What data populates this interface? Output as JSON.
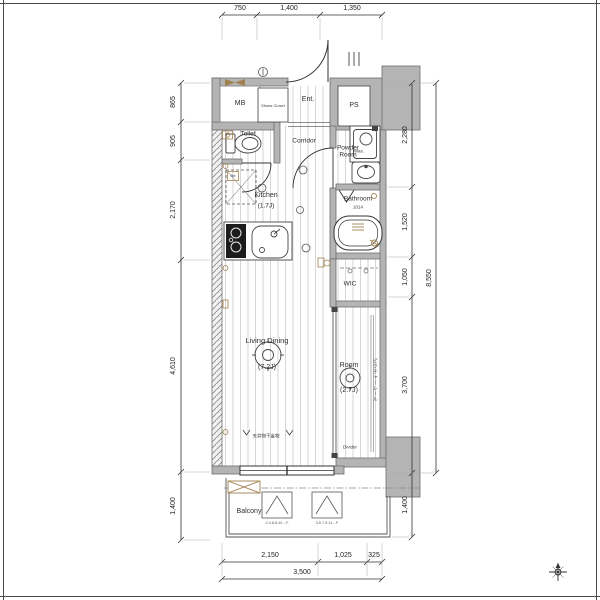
{
  "colors": {
    "wall_fill": "#b4b4b4",
    "wall_stroke": "#6f6f6f",
    "line": "#3c3c3c",
    "floor_stripe": "#d6d6d6",
    "accent_brown": "#a0824f",
    "text": "#2e2e2e"
  },
  "rooms": {
    "mb": {
      "label": "MB"
    },
    "shoes_closet": {
      "label": "Shoes Closet"
    },
    "entrance": {
      "label": "Ent."
    },
    "ps": {
      "label": "PS"
    },
    "toilet": {
      "label": "Toilet"
    },
    "corridor": {
      "label": "Corridor"
    },
    "powder_room": {
      "label": "Powder Room"
    },
    "washer": {
      "label": "Was."
    },
    "kitchen": {
      "label": "Kitchen",
      "size": "(1.7J)"
    },
    "bathroom": {
      "label": "Bathroom",
      "size": "1014"
    },
    "wic": {
      "label": "WIC"
    },
    "living_dining": {
      "label": "Living Dining",
      "size": "(7.2J)"
    },
    "room": {
      "label": "Room",
      "size": "(2.7J)"
    },
    "balcony": {
      "label": "Balcony"
    }
  },
  "annotations": {
    "divider": "Divider",
    "picture_rail": "ピクチャーレール",
    "ceiling_laundry_hanger": "天井物干金物",
    "refrigerator": "Re",
    "escape_hatch_floors_even": "2.4.6.8.10…F",
    "escape_hatch_floors_odd": "3.5.7.9.11…F"
  },
  "dimensions": {
    "top": [
      "750",
      "1,400",
      "1,350"
    ],
    "bottom": [
      "2,150",
      "1,025",
      "325"
    ],
    "bottom_total": "3,500",
    "left": [
      "865",
      "905",
      "2,170",
      "4,610",
      "1,400"
    ],
    "right": [
      "2,280",
      "1,520",
      "1,050",
      "3,700",
      "1,400"
    ],
    "right_total": "8,550"
  },
  "icons": {
    "compass-icon": "8-point star with north arrow",
    "meter-box-icon": "brown bowtie",
    "evacuation-hatch-icon": "crossed rectangle",
    "escape-hatch-icon": "triangle in box",
    "entrance-door-icon": "quarter-circle swing",
    "stove-icon": "black 2-burner",
    "toilet-icon": "tank and bowl",
    "bathtub-icon": "rounded rectangle tub"
  }
}
